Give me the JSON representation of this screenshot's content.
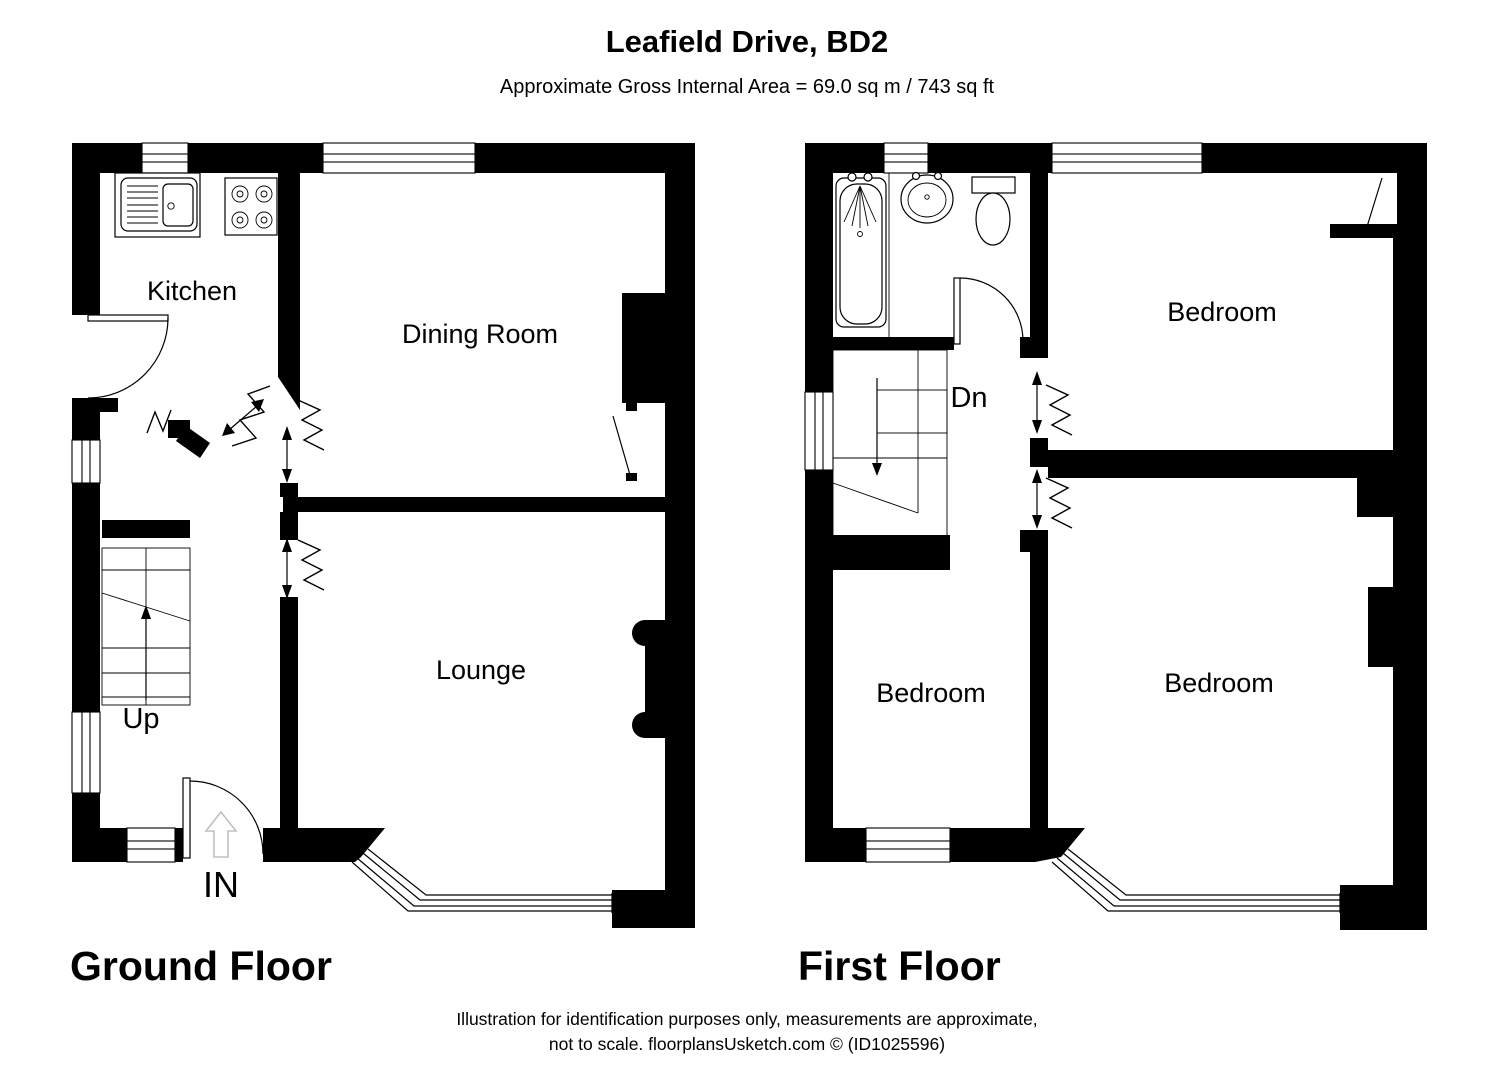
{
  "header": {
    "title": "Leafield Drive, BD2",
    "subtitle": "Approximate Gross Internal Area = 69.0 sq m / 743 sq ft"
  },
  "ground_floor": {
    "label": "Ground Floor",
    "rooms": {
      "kitchen": "Kitchen",
      "dining_room": "Dining Room",
      "lounge": "Lounge"
    },
    "stairs_label": "Up",
    "entrance_label": "IN"
  },
  "first_floor": {
    "label": "First Floor",
    "rooms": {
      "bedroom_top": "Bedroom",
      "bedroom_left": "Bedroom",
      "bedroom_right": "Bedroom"
    },
    "stairs_label": "Dn"
  },
  "footer": {
    "line1": "Illustration for identification purposes only, measurements are approximate,",
    "line2": "not to scale. floorplansUsketch.com © (ID1025596)"
  },
  "colors": {
    "wall": "#000000",
    "background": "#ffffff",
    "entry_arrow": "#c0c0c0"
  }
}
